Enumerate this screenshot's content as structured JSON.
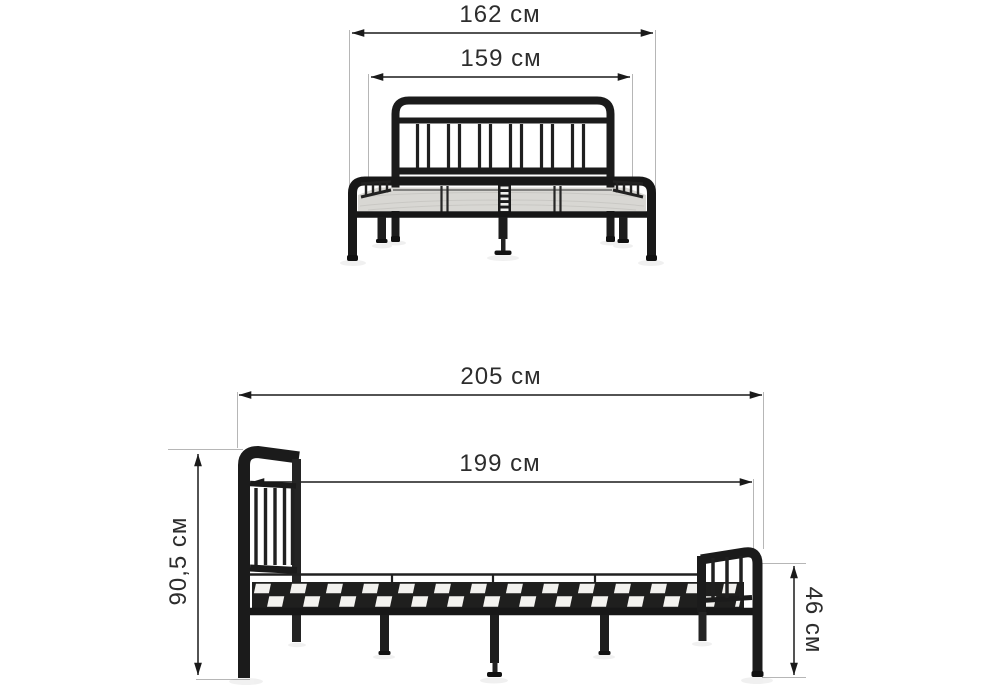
{
  "page": {
    "title": "Bed frame dimension diagram",
    "views": [
      "front view",
      "side view"
    ]
  },
  "dimensions": {
    "front_total_width": "162 см",
    "front_inner_width": "159 см",
    "side_total_length": "205 см",
    "side_inner_length": "199 см",
    "side_headboard_height": "90,5 см",
    "side_footboard_height": "46 см"
  },
  "colors": {
    "background": "#ffffff",
    "frame_black": "#1b1b1b",
    "deck_gray": "#d8d7d3",
    "slat_light": "#f2f1ee",
    "dimension_line": "#1a1a1a",
    "extension_line": "#b6b6b6",
    "label_text": "#2d2d2d"
  }
}
